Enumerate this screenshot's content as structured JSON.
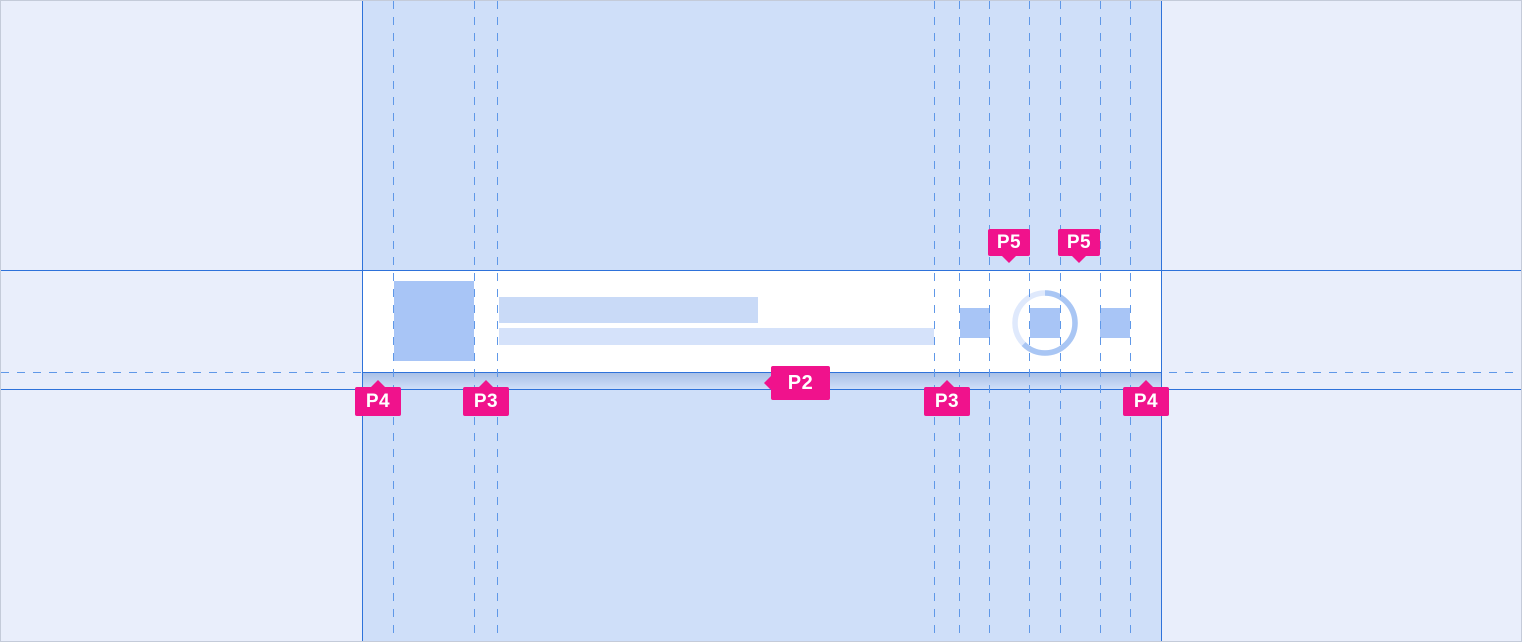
{
  "annotations": {
    "top": [
      {
        "label": "P5"
      },
      {
        "label": "P5"
      }
    ],
    "middle": [
      {
        "label": "P2"
      }
    ],
    "bottom": [
      {
        "label": "P4"
      },
      {
        "label": "P3"
      },
      {
        "label": "P3"
      },
      {
        "label": "P4"
      }
    ]
  },
  "colors": {
    "accent_pink": "#f0128c",
    "guide_blue": "#2e72da",
    "guide_dashed_blue": "#5f98e8",
    "page_bg": "#e9eefb",
    "band_bg": "#cfdff9",
    "row_bg": "#ffffff",
    "row_shadow_top": "#a9c0e6",
    "placeholder_avatar": "#a8c5f6",
    "placeholder_title_bar": "#c9daf7",
    "placeholder_subtitle_bar": "#d5e2fa",
    "placeholder_icon": "#a8c5f6",
    "spinner_track": "#dfe9fc",
    "spinner_arc": "#a9c6f4"
  }
}
